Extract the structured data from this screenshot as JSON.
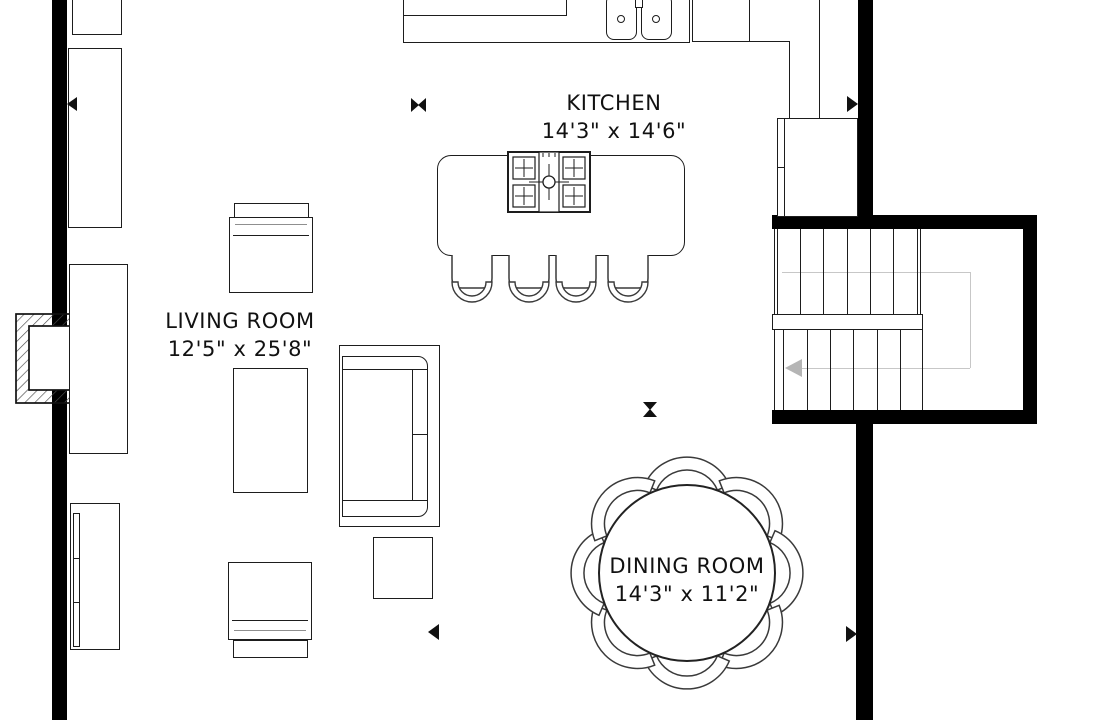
{
  "floorplan": {
    "rooms": [
      {
        "name": "KITCHEN",
        "dims": "14'3\" x 14'6\""
      },
      {
        "name": "LIVING ROOM",
        "dims": "12'5\" x 25'8\""
      },
      {
        "name": "DINING ROOM",
        "dims": "14'3\" x 11'2\""
      }
    ],
    "colors": {
      "wall": "#000000",
      "furniture_line": "#1d1d1d",
      "stair_guide": "#c7c7c7"
    }
  }
}
